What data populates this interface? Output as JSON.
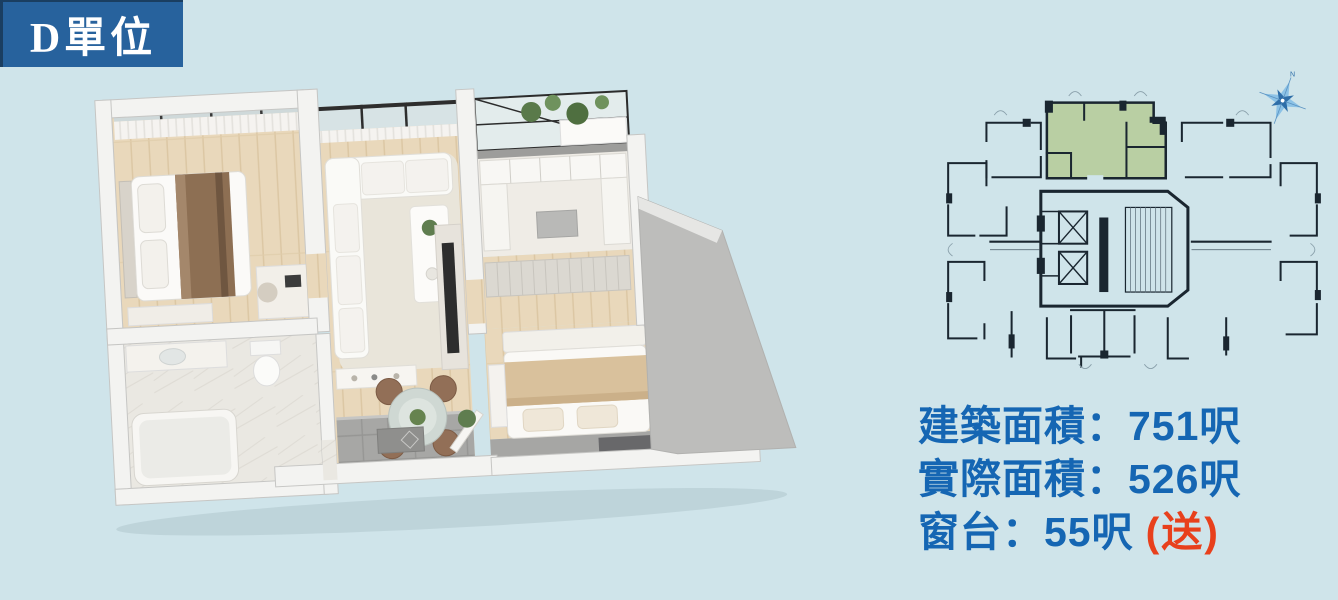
{
  "page": {
    "background_color": "#CFE4EA"
  },
  "title_badge": {
    "label": "D單位",
    "background_color": "#27629D",
    "text_color": "#FFFFFF"
  },
  "key_plan": {
    "highlighted_unit": "D",
    "highlight_color": "#B9CFA3",
    "line_color": "#1A2630",
    "compass_icon": "north-compass-icon"
  },
  "specs": {
    "text_color": "#1566B3",
    "note_color": "#E8401C",
    "lines": [
      {
        "label": "建築面積",
        "separator": "：",
        "value": "751呎",
        "note": ""
      },
      {
        "label": "實際面積",
        "separator": "：",
        "value": "526呎",
        "note": ""
      },
      {
        "label": "窗台",
        "separator": "：",
        "value": "55呎",
        "note": "(送)"
      }
    ]
  }
}
